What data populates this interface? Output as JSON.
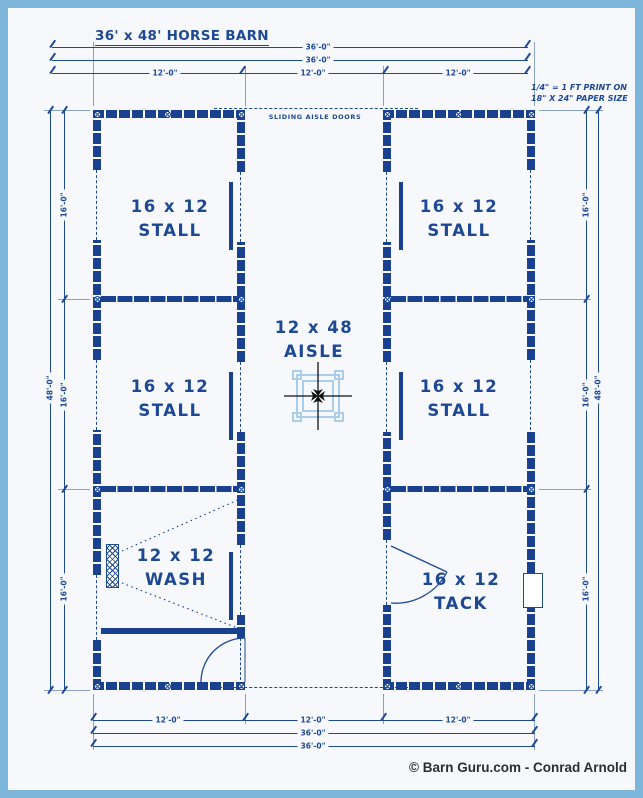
{
  "page": {
    "title": "36' x 48' HORSE BARN",
    "copyright": "© Barn Guru.com - Conrad Arnold"
  },
  "scale_note": {
    "line1": "1/4\" = 1 FT PRINT ON",
    "line2": "18\" X 24\" PAPER SIZE"
  },
  "labels": {
    "sliding_aisle_doors": "SLIDING AISLE DOORS"
  },
  "rooms": {
    "stall_tl": {
      "size": "16 x 12",
      "name": "STALL"
    },
    "stall_ml": {
      "size": "16 x 12",
      "name": "STALL"
    },
    "wash": {
      "size": "12 x 12",
      "name": "WASH"
    },
    "stall_tr": {
      "size": "16 x 12",
      "name": "STALL"
    },
    "stall_mr": {
      "size": "16 x 12",
      "name": "STALL"
    },
    "tack": {
      "size": "16 x 12",
      "name": "TACK"
    },
    "aisle": {
      "size": "12 x 48",
      "name": "AISLE"
    }
  },
  "dimensions": {
    "top": {
      "overall_1": "36'-0\"",
      "overall_2": "36'-0\"",
      "bay_left": "12'-0\"",
      "bay_mid": "12'-0\"",
      "bay_right": "12'-0\""
    },
    "bottom": {
      "bay_left": "12'-0\"",
      "bay_mid": "12'-0\"",
      "bay_right": "12'-0\"",
      "overall_1": "36'-0\"",
      "overall_2": "36'-0\""
    },
    "left": {
      "overall": "48'-0\"",
      "seg_1": "16'-0\"",
      "seg_2": "16'-0\"",
      "seg_3": "16'-0\""
    },
    "right": {
      "overall": "48'-0\"",
      "seg_1": "16'-0\"",
      "seg_2": "16'-0\"",
      "seg_3": "16'-0\""
    }
  },
  "colors": {
    "ink": "#1d4894",
    "wall": "#1a4190",
    "frame_border": "#7eb5db",
    "paper": "#f6f8fb",
    "drain": "#a9cdea"
  }
}
